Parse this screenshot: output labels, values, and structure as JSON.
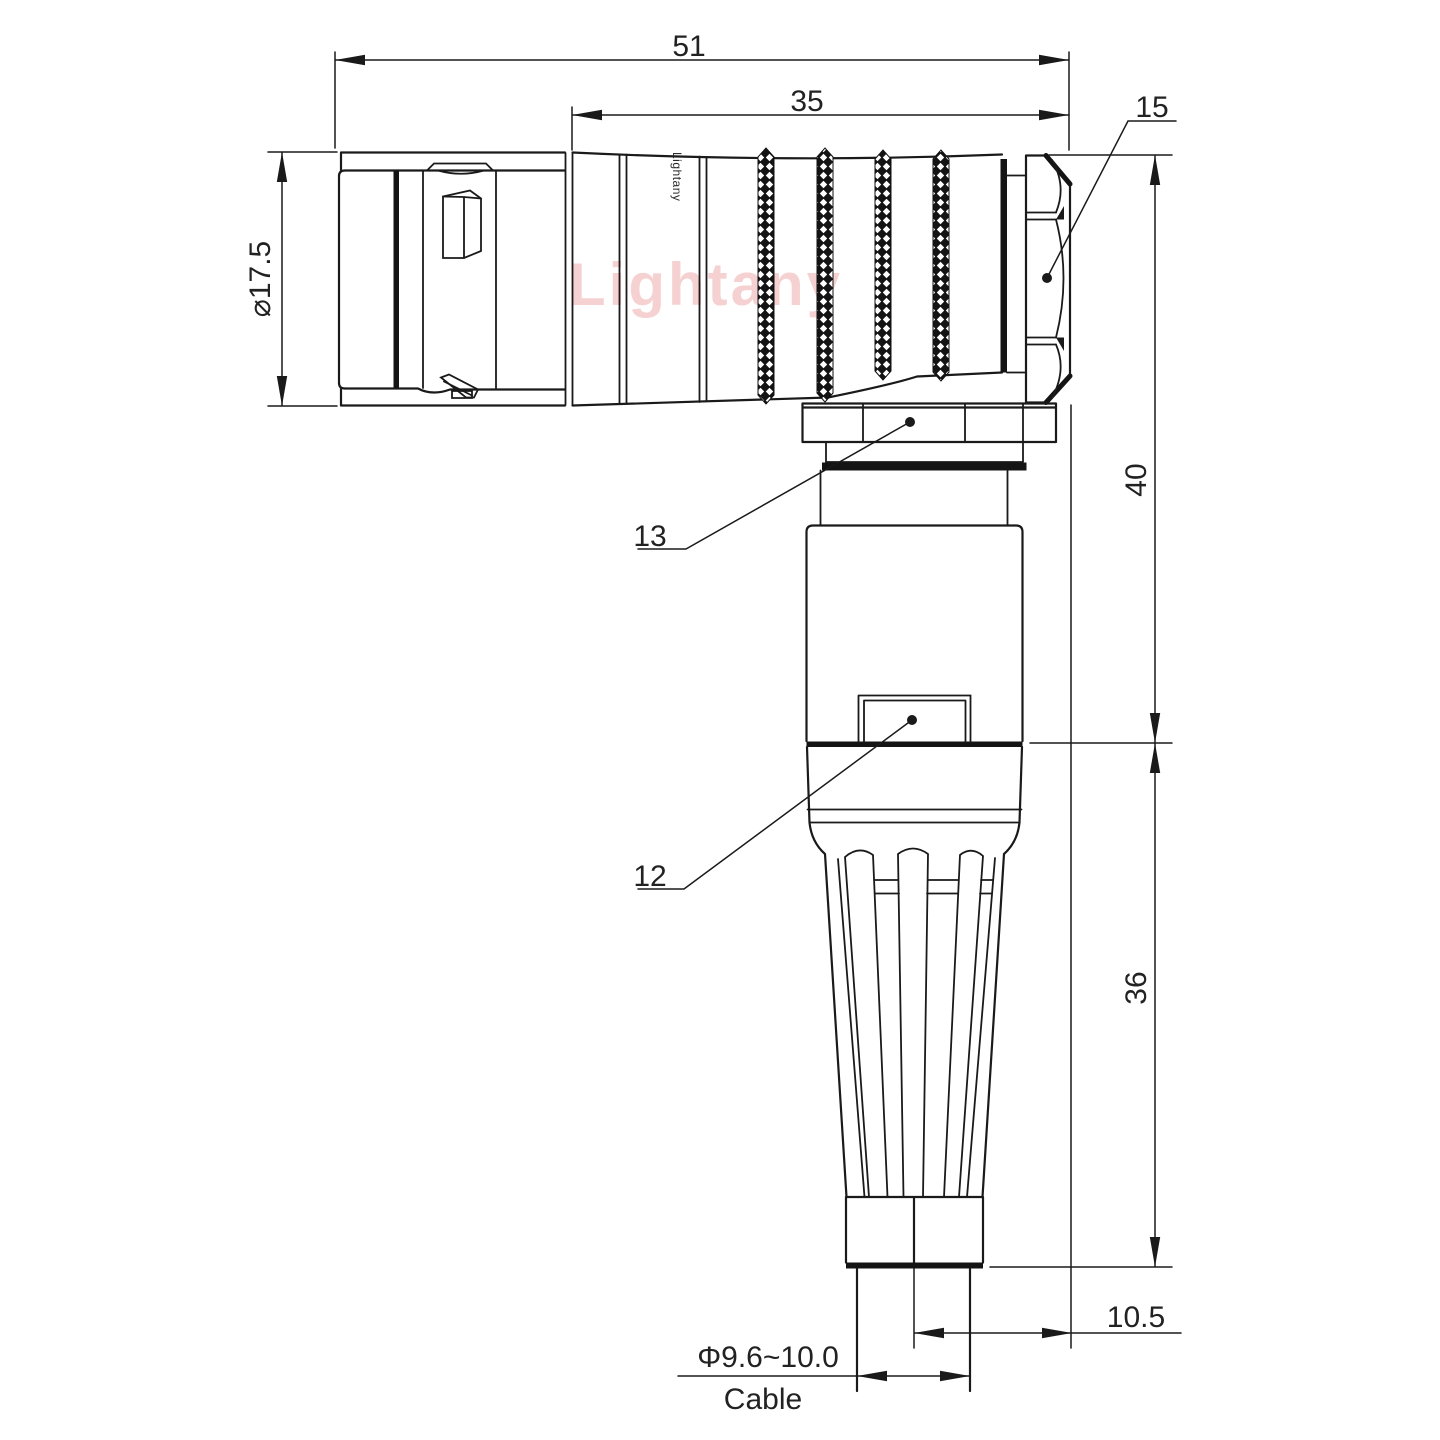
{
  "watermark": "Lightany",
  "brand_mark": "Lightany",
  "dims": {
    "overall_length": "51",
    "rear_length": "35",
    "body_diameter": "⌀17.5",
    "height_upper": "40",
    "height_lower": "36",
    "side_offset": "10.5",
    "cable_diameter": "Φ9.6~10.0",
    "cable_label": "Cable"
  },
  "labels": {
    "hex_nut": "15",
    "coupling_nut": "13",
    "cable_clamp": "12"
  },
  "colors": {
    "line": "#1a1a1a",
    "text": "#222222",
    "watermark": "#f5caca",
    "background": "#ffffff"
  }
}
